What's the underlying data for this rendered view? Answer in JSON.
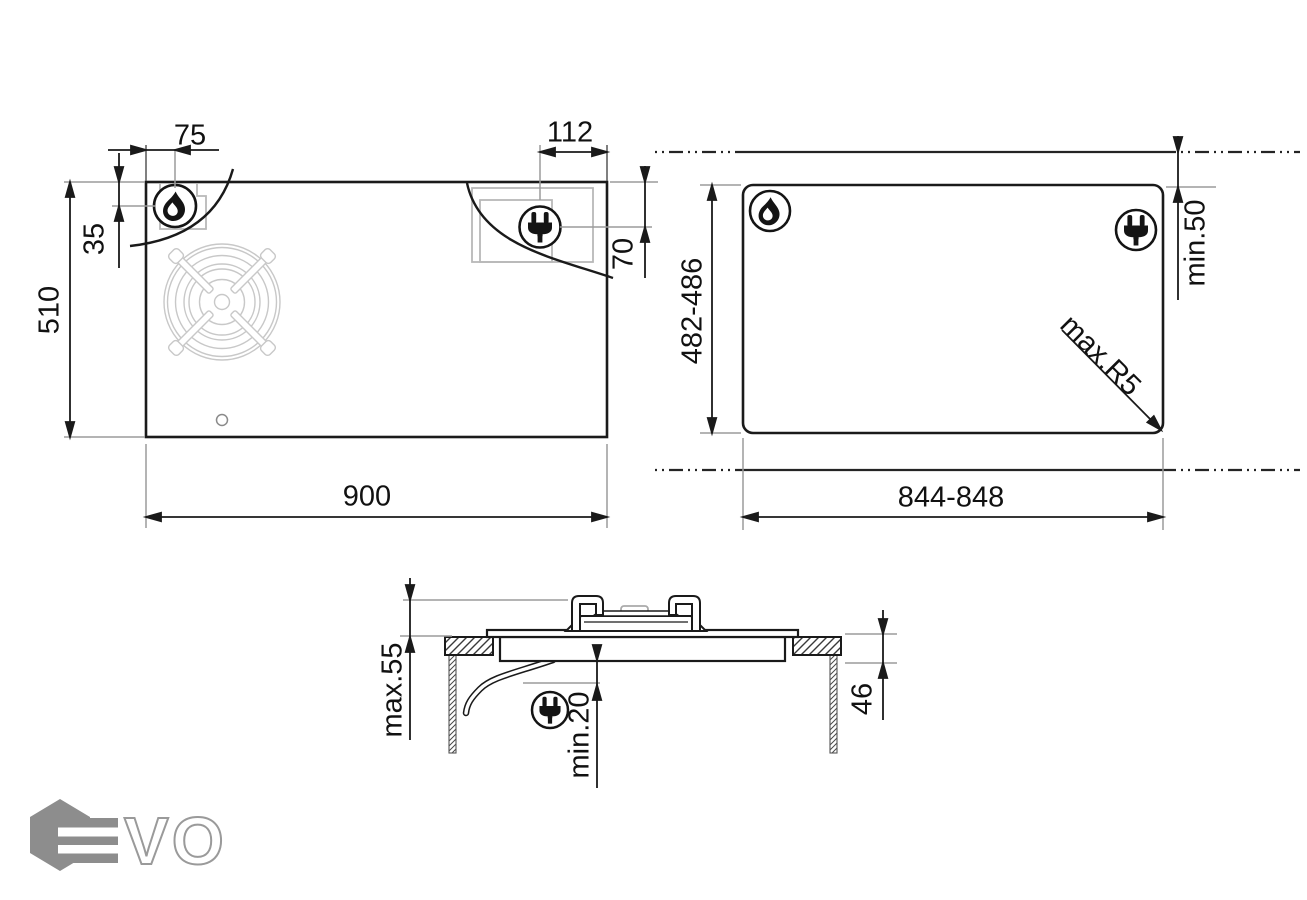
{
  "views": {
    "top_view": {
      "width": "900",
      "height": "510",
      "gas_offset_left": "75",
      "gas_offset_top": "35",
      "elec_offset": "112",
      "elec_depth": "70"
    },
    "cutout_view": {
      "width": "844-848",
      "height": "482-486",
      "rear_clearance": "min.50",
      "corner_radius": "max.R5"
    },
    "section_view": {
      "height_above": "max.55",
      "clearance_below": "min.20",
      "recess_depth": "46"
    }
  },
  "icons": {
    "gas": "flame-icon",
    "electric": "plug-icon"
  },
  "logo": {
    "brand": "EVO",
    "vo": "VO"
  },
  "colors": {
    "line": "#1a1a1a",
    "extension": "#9b9b9b",
    "zone": "#b8b8b8",
    "grate": "#c8c8c8",
    "logo_gray": "#8d8d8d"
  }
}
